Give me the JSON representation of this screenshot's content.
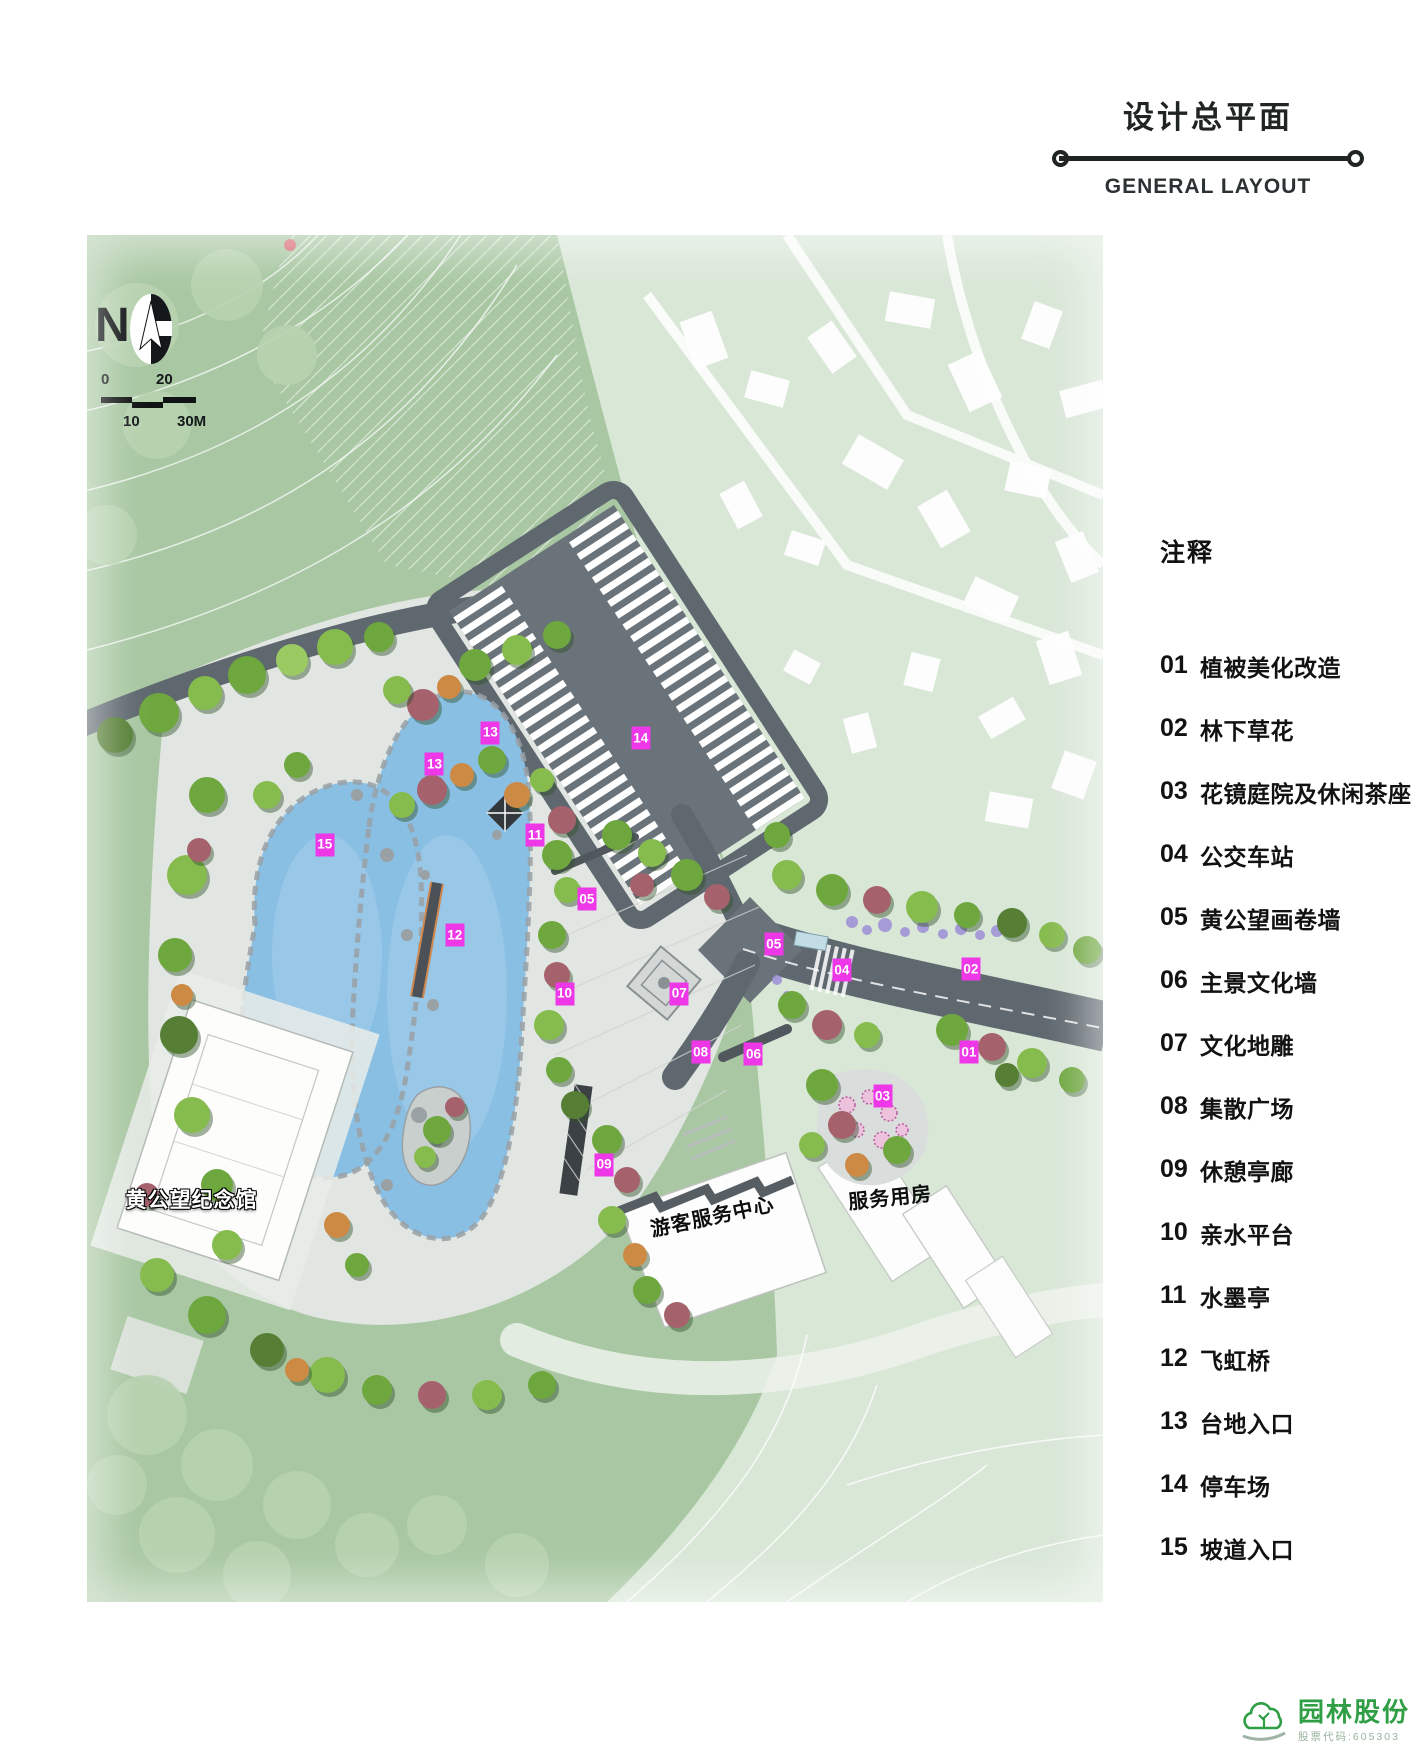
{
  "title": {
    "zh": "设计总平面",
    "en": "GENERAL LAYOUT"
  },
  "legend": {
    "heading": "注释",
    "items": [
      {
        "num": "01",
        "label": "植被美化改造"
      },
      {
        "num": "02",
        "label": "林下草花"
      },
      {
        "num": "03",
        "label": "花镜庭院及休闲茶座"
      },
      {
        "num": "04",
        "label": "公交车站"
      },
      {
        "num": "05",
        "label": "黄公望画卷墙"
      },
      {
        "num": "06",
        "label": "主景文化墙"
      },
      {
        "num": "07",
        "label": "文化地雕"
      },
      {
        "num": "08",
        "label": "集散广场"
      },
      {
        "num": "09",
        "label": "休憩亭廊"
      },
      {
        "num": "10",
        "label": "亲水平台"
      },
      {
        "num": "11",
        "label": "水墨亭"
      },
      {
        "num": "12",
        "label": "飞虹桥"
      },
      {
        "num": "13",
        "label": "台地入口"
      },
      {
        "num": "14",
        "label": "停车场"
      },
      {
        "num": "15",
        "label": "坡道入口"
      }
    ]
  },
  "map": {
    "north_label": "N",
    "scale_labels": {
      "zero": "0",
      "twenty": "20",
      "ten": "10",
      "thirty": "30M"
    },
    "site_labels": [
      {
        "text": "黄公望纪念馆",
        "x": 10.3,
        "y": 70.5,
        "rot": 0,
        "style": "white"
      },
      {
        "text": "游客服务中心",
        "x": 61.5,
        "y": 71.7,
        "rot": -12,
        "style": "black"
      },
      {
        "text": "服务用房",
        "x": 79.0,
        "y": 70.3,
        "rot": -6,
        "style": "black"
      }
    ],
    "markers": [
      {
        "num": "01",
        "x": 86.8,
        "y": 59.8
      },
      {
        "num": "02",
        "x": 87.0,
        "y": 53.7
      },
      {
        "num": "03",
        "x": 78.3,
        "y": 63.0
      },
      {
        "num": "04",
        "x": 74.3,
        "y": 53.8
      },
      {
        "num": "05",
        "x": 49.2,
        "y": 48.6
      },
      {
        "num": "05",
        "x": 67.6,
        "y": 51.9
      },
      {
        "num": "06",
        "x": 65.6,
        "y": 59.9
      },
      {
        "num": "07",
        "x": 58.3,
        "y": 55.5
      },
      {
        "num": "08",
        "x": 60.4,
        "y": 59.8
      },
      {
        "num": "09",
        "x": 50.9,
        "y": 68.0
      },
      {
        "num": "10",
        "x": 47.0,
        "y": 55.5
      },
      {
        "num": "11",
        "x": 44.1,
        "y": 43.9
      },
      {
        "num": "12",
        "x": 36.2,
        "y": 51.2
      },
      {
        "num": "13",
        "x": 39.7,
        "y": 36.4
      },
      {
        "num": "13",
        "x": 34.2,
        "y": 38.7
      },
      {
        "num": "14",
        "x": 54.5,
        "y": 36.8
      },
      {
        "num": "15",
        "x": 23.4,
        "y": 44.6
      }
    ]
  },
  "footer": {
    "brand": "园林股份",
    "stock_code": "股票代码:605303"
  },
  "colors": {
    "marker": "#ee38e8",
    "road": "#5f686f",
    "water": "#8abfe4",
    "logo_green": "#2f9e45"
  }
}
